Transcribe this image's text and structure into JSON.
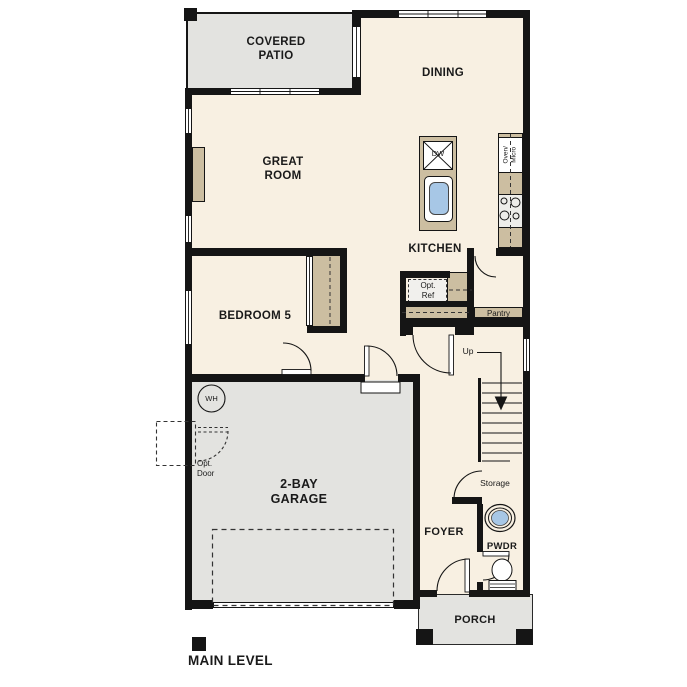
{
  "labels": {
    "covered_patio": "COVERED PATIO",
    "dining": "DINING",
    "great_room": "GREAT ROOM",
    "kitchen": "KITCHEN",
    "bedroom5": "BEDROOM 5",
    "garage": "2-BAY GARAGE",
    "foyer": "FOYER",
    "pwdr": "PWDR",
    "porch": "PORCH",
    "pantry": "Pantry",
    "storage": "Storage",
    "up": "Up",
    "wh": "WH",
    "dw": "DW",
    "oven_micro": "Oven/ Micro",
    "opt_ref": "Opt. Ref",
    "opt_door": "Opt. Door",
    "main_level": "MAIN LEVEL"
  },
  "colors": {
    "wall": "#151515",
    "floor": "#f8f0e2",
    "slab": "#e3e3e0",
    "counter": "#ccbea1",
    "sink": "#a7c7e6",
    "appliance": "#ededea",
    "optional_fill": "#f1f0ed",
    "text": "#1a1a1a"
  }
}
